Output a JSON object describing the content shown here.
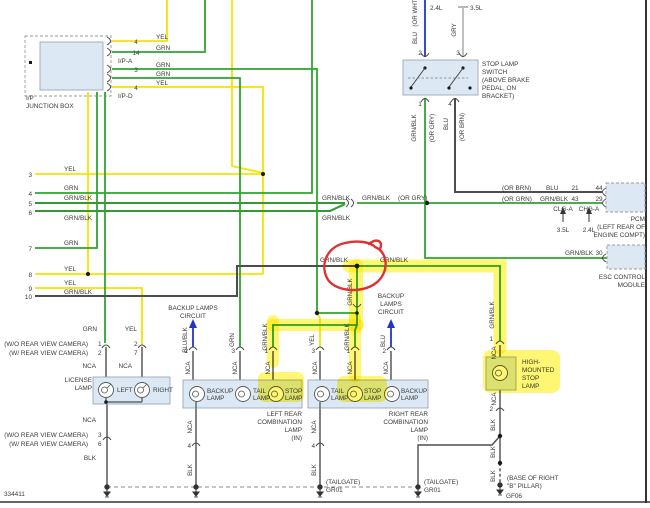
{
  "meta": {
    "diagram_id": "334411"
  },
  "common": {
    "nca": "NCA",
    "grnblk": "GRN/BLK",
    "yel": "YEL",
    "grn": "GRN",
    "blk": "BLK",
    "blu": "BLU",
    "lamp": "LAMP"
  },
  "colors": {
    "wire_yellow": "#f2e400",
    "wire_green": "#2fa52f",
    "wire_dark": "#4d4d4d",
    "wire_blue": "#2233cc",
    "wire_gray": "#b9b9b9",
    "box_fill": "#dce9f5",
    "highlight": "#ffee00",
    "annotation_red": "#e03030"
  },
  "junction_box": {
    "l1": "I/P",
    "l2": "JUNCTION BOX",
    "conn_a": "I/P-A",
    "conn_d": "I/P-D",
    "p1n": "4",
    "p1c": "YEL",
    "p2n": "14",
    "p2c": "GRN",
    "p3n": "3",
    "p3c": "GRN",
    "p4c": "GRN",
    "p5n": "4",
    "p5c": "YEL"
  },
  "rows": {
    "n3": "3",
    "c3": "YEL",
    "n4": "4",
    "c4": "GRN",
    "n5": "5",
    "c5": "GRN/BLK",
    "n6": "6",
    "c6": "GRN/BLK",
    "n7": "7",
    "c7": "GRN",
    "n8": "8",
    "c8": "YEL",
    "n9": "9",
    "c9": "YEL",
    "n10": "10",
    "c10": "GRN/BLK"
  },
  "switch": {
    "eng24": "2.4L",
    "eng35": "3.5L",
    "blu_top": "BLU",
    "orwht": "(OR WHT)",
    "gry": "GRY",
    "p2": "2",
    "p3": "3",
    "p1": "1",
    "p4": "4",
    "name1": "STOP LAMP",
    "name2": "SWITCH",
    "name3": "(ABOVE BRAKE",
    "name4": "PEDAL, ON",
    "name5": "BRACKET)",
    "orgry": "(OR GRY)",
    "orbrn": "(OR BRN)"
  },
  "mid": {
    "orgry": "(OR GRY)"
  },
  "pcm": {
    "orbrn": "(OR BRN)",
    "blu": "BLU",
    "p21": "21",
    "p44": "44",
    "orgrn": "(OR GRN)",
    "gb": "GRN/BLK",
    "p43": "43",
    "p29": "29",
    "clga": "CLG-A",
    "chga": "CHG-A",
    "e35": "3.5L",
    "e24": "2.4L",
    "name": "PCM",
    "loc1": "(LEFT REAR OF",
    "loc2": "ENGINE COMPT)"
  },
  "esc": {
    "gb": "GRN/BLK",
    "p30": "30",
    "name1": "ESC CONTROL",
    "name2": "MODULE"
  },
  "backup_left": {
    "l1": "BACKUP LAMPS",
    "l2": "CIRCUIT",
    "wire": "BLU/BLK",
    "pin": "2"
  },
  "backup_right": {
    "l1": "BACKUP",
    "l2": "LAMPS",
    "l3": "CIRCUIT",
    "wire": "BLU",
    "pin": "2"
  },
  "license": {
    "wo_cam": "(W/O REAR VIEW CAMERA)",
    "w_cam": "(W/ REAR VIEW CAMERA)",
    "pin1": "1",
    "pin2": "2",
    "pin2b": "2",
    "pin7": "7",
    "pin3": "3",
    "pin6": "6",
    "t1": "LICENSE",
    "t2": "LAMP",
    "left": "LEFT",
    "right": "RIGHT"
  },
  "combo_left": {
    "pin2": "2",
    "pin3": "3",
    "pin1": "1",
    "pin4": "4",
    "bk1": "BACKUP",
    "bk2": "LAMP",
    "tl1": "TAIL",
    "tl2": "LAMP",
    "st1": "STOP",
    "st2": "LAMP",
    "cap1": "LEFT REAR",
    "cap2": "COMBINATION",
    "cap3": "LAMP",
    "cap4": "(IN)"
  },
  "combo_right": {
    "pin3": "3",
    "pin1": "1",
    "pin2": "2",
    "pin4": "4",
    "tl1": "TAIL",
    "tl2": "LAMP",
    "st1": "STOP",
    "st2": "LAMP",
    "bk1": "BACKUP",
    "bk2": "LAMP",
    "cap1": "RIGHT REAR",
    "cap2": "COMBINATION",
    "cap3": "LAMP",
    "cap4": "(IN)",
    "tailgate": "(TAILGATE)",
    "gr": "GR01"
  },
  "high_mount": {
    "pin1": "1",
    "pin2": "2",
    "t1": "HIGH-",
    "t2": "MOUNTED",
    "t3": "STOP",
    "t4": "LAMP",
    "tailgate": "(TAILGATE)",
    "gr": "GR01",
    "base1": "(BASE OF RIGHT",
    "base2": "\"B\" PILLAR)",
    "gf": "GF06"
  }
}
